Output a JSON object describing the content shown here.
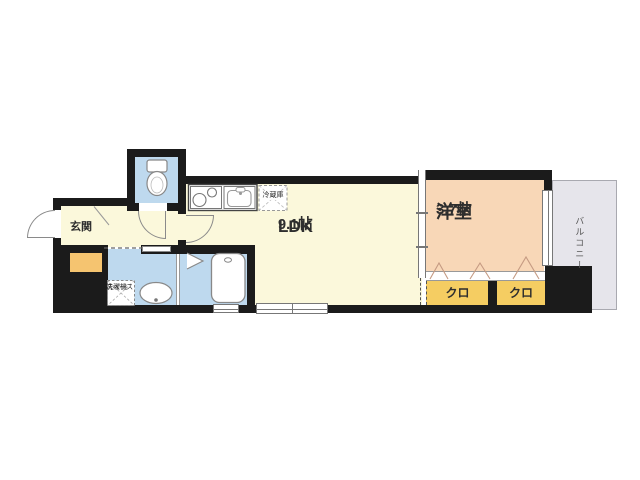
{
  "rooms": {
    "ldk": {
      "name": "LDK",
      "size": "9.1帖"
    },
    "bedroom": {
      "name": "洋室",
      "size": "3.7帖"
    },
    "entrance": {
      "label": "玄関"
    },
    "closet_left": {
      "label": "クロ"
    },
    "closet_right": {
      "label": "クロ"
    },
    "balcony": {
      "label": "バルコニー"
    },
    "kitchen": {
      "refrigerator_label": "冷蔵庫"
    },
    "washroom": {
      "washer_label_line1": "洗濯機",
      "washer_label_line2": "スペース"
    }
  },
  "colors": {
    "wall": "#1b1b1b",
    "floor_yellow": "#FBF8DB",
    "bedroom_peach": "#F8D7B7",
    "closet_yellow": "#F5CD62",
    "entrance_step_orange": "#F5C470",
    "water_blue": "#BED9EE",
    "balcony_gray": "#E6E5EB"
  }
}
